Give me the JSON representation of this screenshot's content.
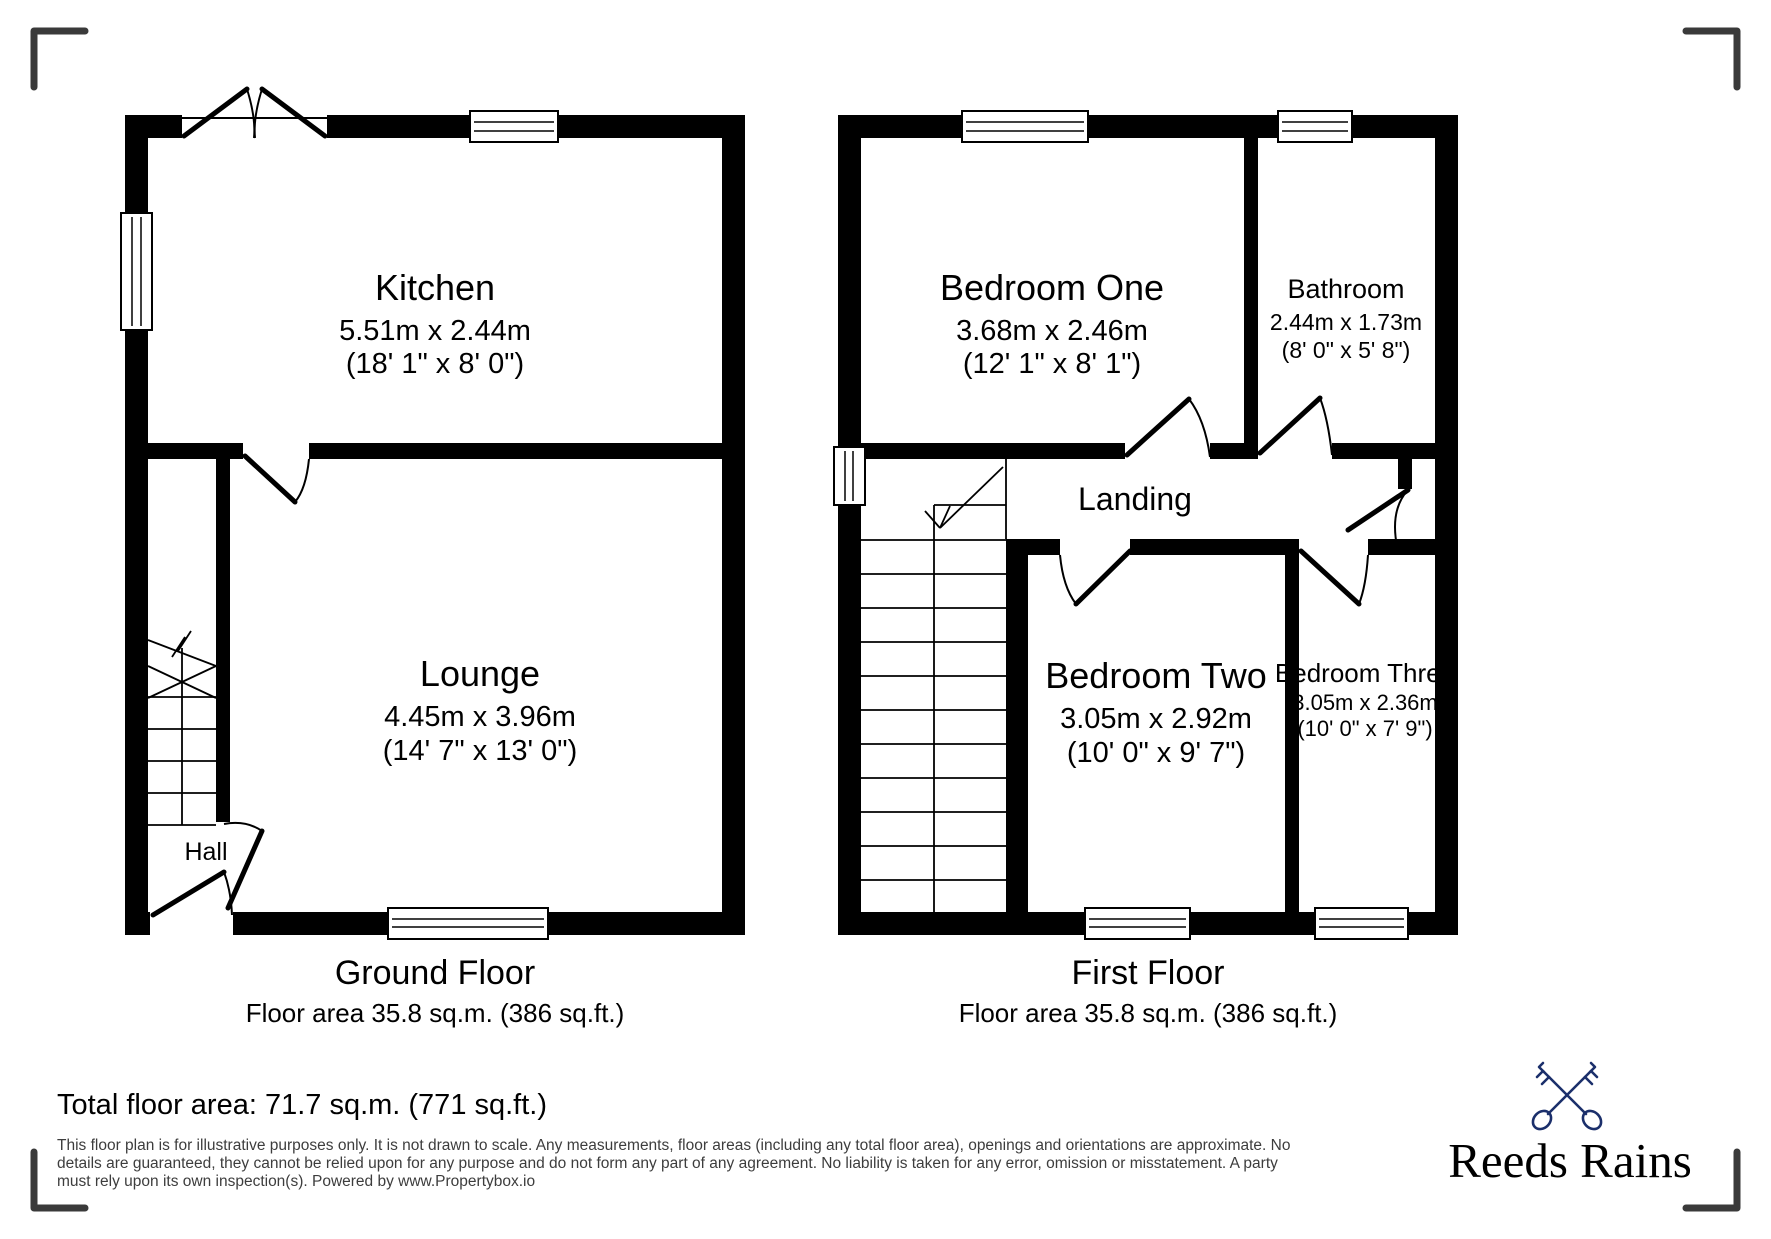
{
  "ground_floor": {
    "title": "Ground Floor",
    "area_label": "Floor area 35.8 sq.m. (386 sq.ft.)",
    "kitchen": {
      "name": "Kitchen",
      "metric": "5.51m x 2.44m",
      "imperial": "(18' 1\" x 8' 0\")"
    },
    "lounge": {
      "name": "Lounge",
      "metric": "4.45m x 3.96m",
      "imperial": "(14' 7\" x 13' 0\")"
    },
    "hall": {
      "name": "Hall"
    }
  },
  "first_floor": {
    "title": "First Floor",
    "area_label": "Floor area 35.8 sq.m. (386 sq.ft.)",
    "bedroom_one": {
      "name": "Bedroom One",
      "metric": "3.68m x 2.46m",
      "imperial": "(12' 1\" x 8' 1\")"
    },
    "bathroom": {
      "name": "Bathroom",
      "metric": "2.44m x 1.73m",
      "imperial": "(8' 0\" x 5' 8\")"
    },
    "landing": {
      "name": "Landing"
    },
    "bedroom_two": {
      "name": "Bedroom Two",
      "metric": "3.05m x 2.92m",
      "imperial": "(10' 0\" x 9' 7\")"
    },
    "bedroom_three": {
      "name": "Bedroom Three",
      "metric": "3.05m x 2.36m",
      "imperial": "(10' 0\" x 7' 9\")"
    }
  },
  "footer": {
    "total_area": "Total floor area: 71.7 sq.m. (771 sq.ft.)",
    "disclaimer_line1": "This floor plan is for illustrative purposes only. It is not drawn to scale. Any measurements, floor areas (including any total floor area), openings and orientations are approximate. No",
    "disclaimer_line2": "details are guaranteed, they cannot be relied upon for any purpose and do not form any part of any agreement. No liability is taken for any error, omission or misstatement. A party",
    "disclaimer_line3": "must rely upon its own inspection(s). Powered by www.Propertybox.io"
  },
  "brand": {
    "name": "Reeds Rains",
    "color": "#1b2f6b"
  }
}
